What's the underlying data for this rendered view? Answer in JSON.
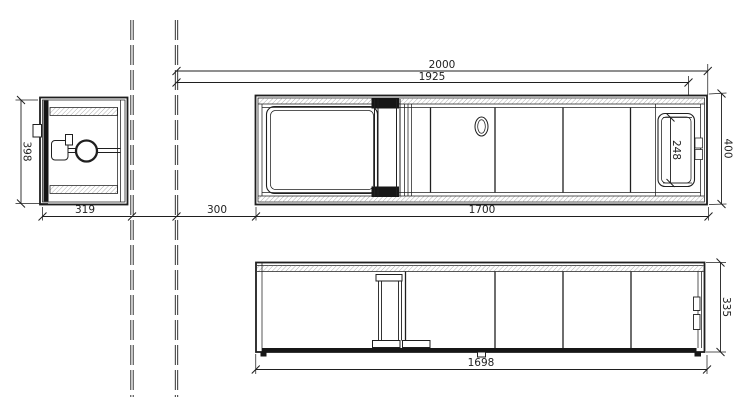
{
  "dimensions": {
    "plan": {
      "overall_length": "2000",
      "inner_length": "1925",
      "left_offset": "300",
      "body_length": "1700",
      "width": "400",
      "basin_inner_width": "248"
    },
    "side": {
      "width": "319",
      "height": "398"
    },
    "front": {
      "height": "335",
      "base_length": "1698"
    }
  },
  "colors": {
    "background": "#ffffff",
    "line": "#1f1f1f",
    "hatch": "#8d8d8d",
    "dark_fill": "#161616"
  }
}
